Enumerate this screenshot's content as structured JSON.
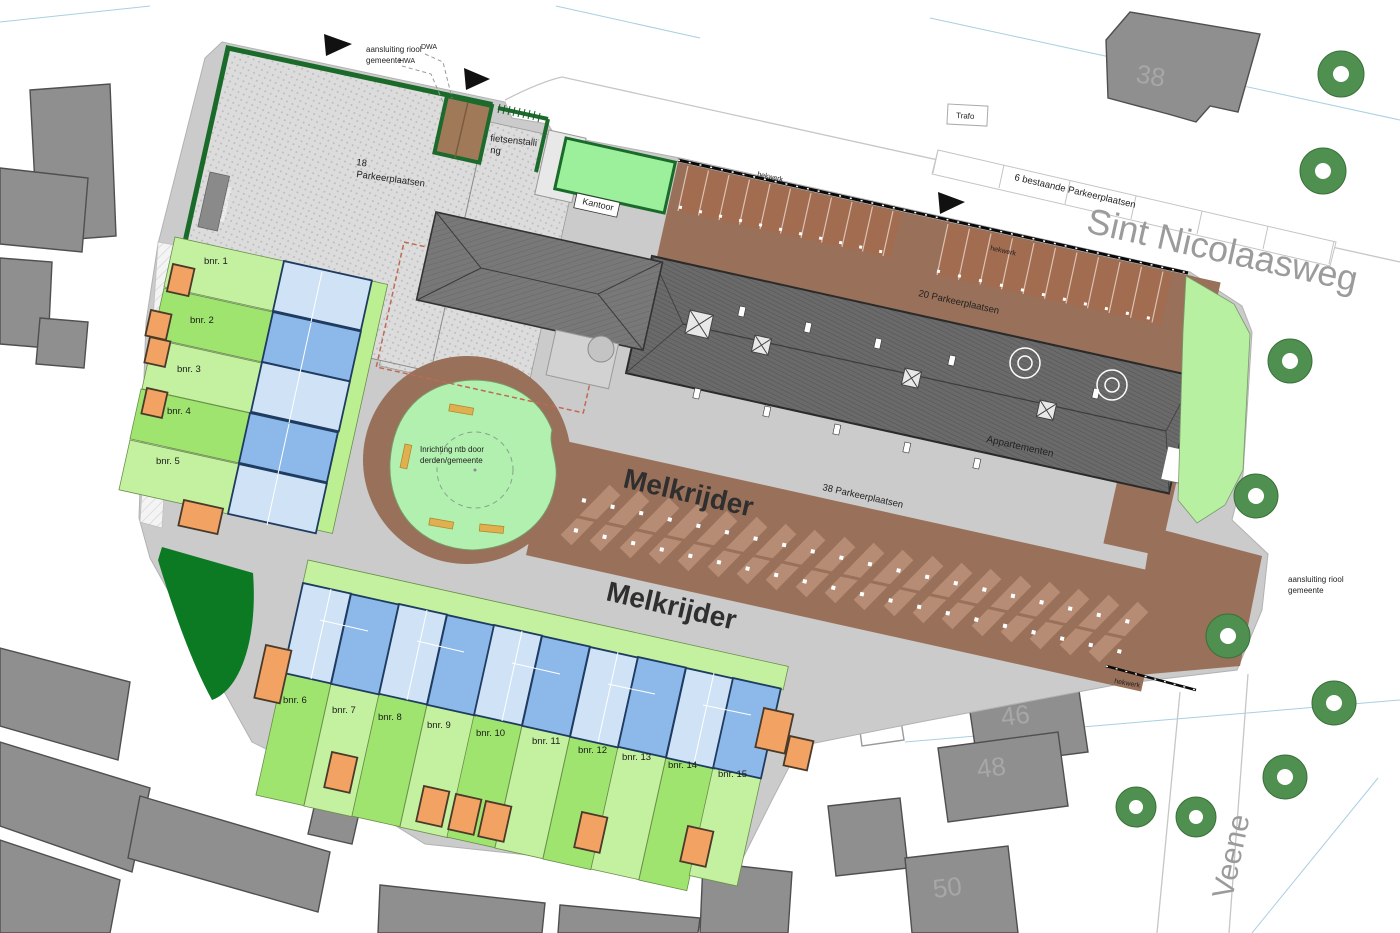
{
  "drawing": {
    "type": "site-plan",
    "streets": {
      "sint_nicolaasweg": "Sint Nicolaasweg",
      "veene": "Veene",
      "melkrijder": "Melkrijder"
    },
    "annotations": {
      "aansluiting_line1": "aansluiting riool",
      "aansluiting_line2": "gemeente",
      "dwa": "DWA",
      "hwa": "HWA",
      "p18_line1": "18",
      "p18_line2": "Parkeerplaatsen",
      "fietsenstalling_line1": "fietsenstalli",
      "fietsenstalling_line2": "ng",
      "fietsklemmen": "fietsklemmen",
      "kantoor": "Kantoor",
      "hekwerk": "hekwerk",
      "trafo": "Trafo",
      "bestaande": "6 bestaande Parkeerplaatsen",
      "p20": "20 Parkeerplaatsen",
      "p38": "38 Parkeerplaatsen",
      "appartementen": "Appartementen",
      "inrichting_line1": "Inrichting ntb door",
      "inrichting_line2": "derden/gemeente"
    },
    "new_houses": {
      "west_row": [
        "bnr. 1",
        "bnr. 2",
        "bnr. 3",
        "bnr. 4",
        "bnr. 5"
      ],
      "south_row": [
        "bnr. 6",
        "bnr. 7",
        "bnr. 8",
        "bnr. 9",
        "bnr. 10",
        "bnr. 11",
        "bnr. 12",
        "bnr. 13",
        "bnr. 14",
        "bnr. 15"
      ]
    },
    "existing_house_numbers": {
      "n38": "38",
      "n46": "46",
      "n48": "48",
      "n50": "50"
    },
    "colors": {
      "asphalt_brown": "#997059",
      "parking_bay": "#b78c74",
      "stall_dark": "#a26c50",
      "garden_light": "#c4f1a0",
      "garden_medium": "#9fe46f",
      "house_blue_light": "#cfe2f6",
      "house_blue_medium": "#8cb8ea",
      "roof_gray": "#6a6a6a",
      "hedge_green": "#1a6b2a",
      "island_green": "#b2f0b0",
      "tree_green": "#4f8f4f",
      "shed_orange": "#f2a263",
      "pavement_gray": "#cbcbcb",
      "existing_building_gray": "#8f8f8f",
      "cadastral_blue": "#a9cfe2"
    }
  }
}
